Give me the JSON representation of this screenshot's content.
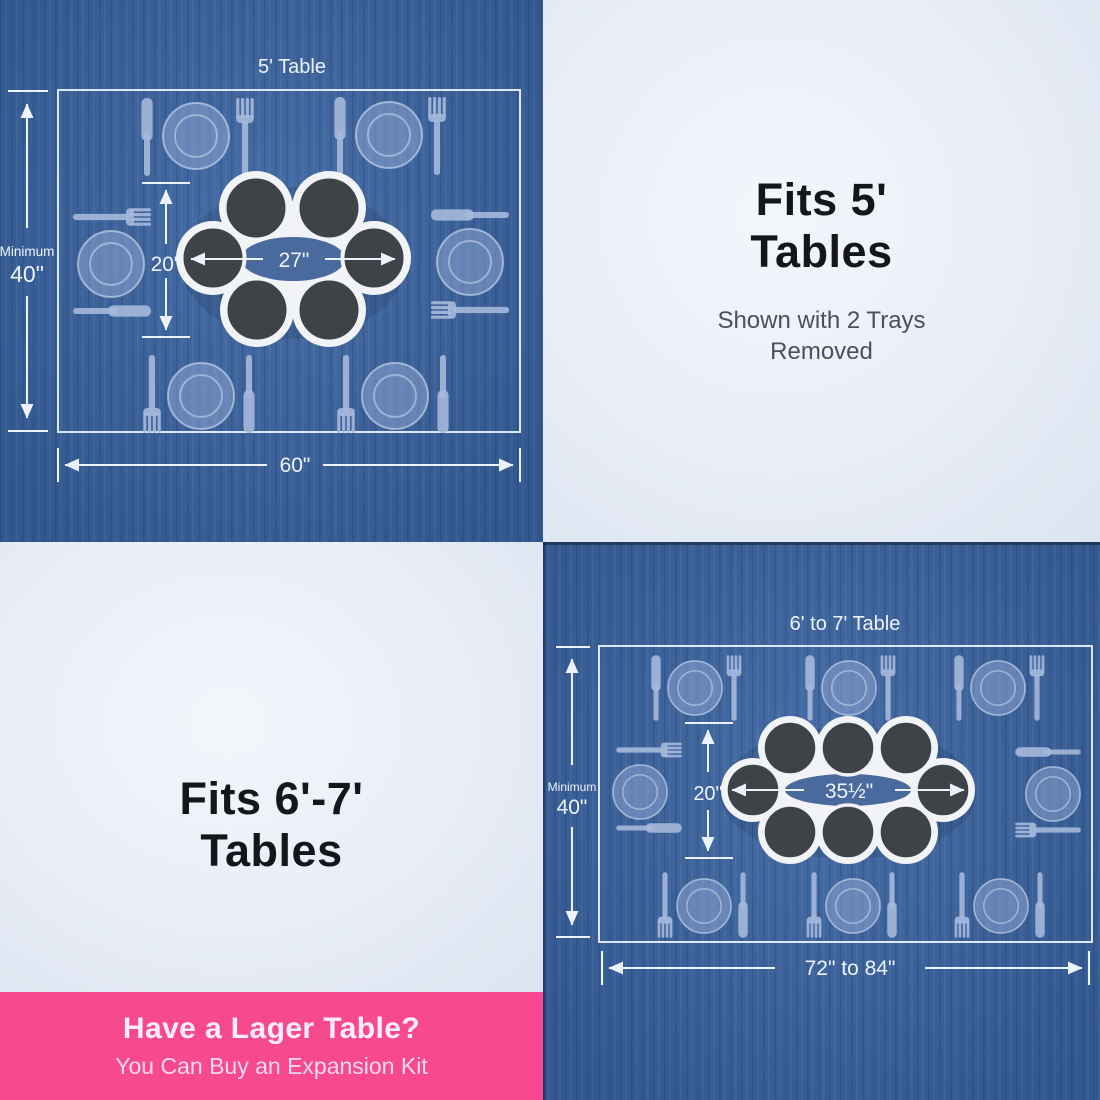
{
  "diagram_5ft": {
    "title": "5' Table",
    "minimum_label": "Minimum",
    "minimum_value": "40\"",
    "table_width": "60\"",
    "turntable_depth": "20\"",
    "turntable_width": "27\"",
    "trays_shown": 6,
    "place_settings": 6
  },
  "callout_5ft": {
    "heading": "Fits 5'\nTables",
    "subtitle": "Shown with 2 Trays\nRemoved"
  },
  "callout_67ft": {
    "heading": "Fits 6'-7'\nTables"
  },
  "diagram_67ft": {
    "title": "6' to 7' Table",
    "minimum_label": "Minimum",
    "minimum_value": "40\"",
    "table_width": "72\" to 84\"",
    "turntable_depth": "20\"",
    "turntable_width": "35½\"",
    "trays_shown": 8,
    "place_settings": 8
  },
  "banner": {
    "heading": "Have a Lager Table?",
    "subtitle": "You Can Buy an Expansion Kit"
  },
  "colors": {
    "table_blue": "#3a63a0",
    "accent_pink": "#f6498f",
    "tray_charcoal": "#3e4347",
    "carrier_white": "#f1f3f6",
    "dimension_white": "#edf3fc",
    "heading_dark": "#15161b"
  }
}
